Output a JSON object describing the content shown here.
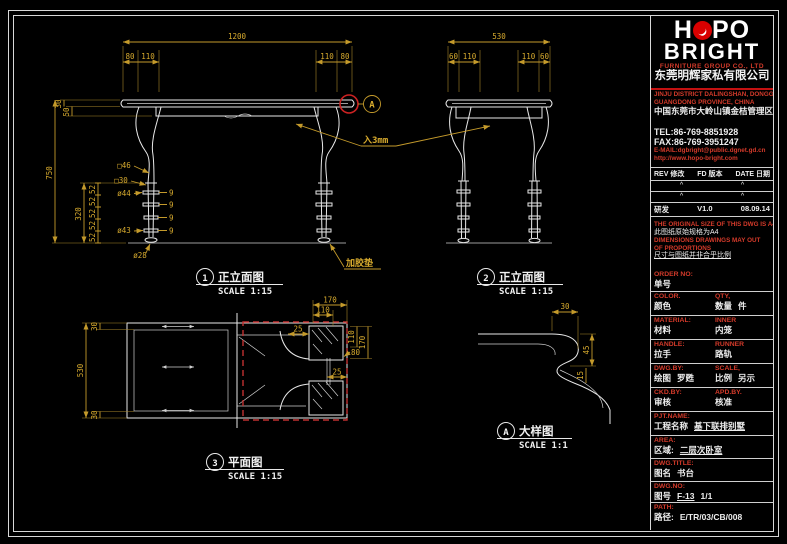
{
  "colors": {
    "background": "#000000",
    "drawing_line": "#e8e8e8",
    "dimension": "#c49a2b",
    "accent_red": "#cc2222",
    "logo_red": "#d90000"
  },
  "logo": {
    "h": "H",
    "po": "PO",
    "bright": "BRIGHT",
    "subtitle": "FURNITURE GROUP CO., LTD",
    "company_cn": "东莞明辉家私有限公司"
  },
  "contact": {
    "addr_en1": "JINJU DISTRICT DALINGSHAN, DONGGUAN",
    "addr_en2": "GUANGDONG PROVINCE, CHINA",
    "addr_cn": "中国东莞市大岭山镇金桔管理区",
    "tel": "TEL:86-769-8851928",
    "fax": "FAX:86-769-3951247",
    "email": "E-MAIL:dgbright@public.dgnet.gd.cn",
    "web": "http://www.hopo-bright.com"
  },
  "revision": {
    "header_rev": "REV 修改",
    "header_fd": "FD 版本",
    "header_date": "DATE 日期",
    "caret": "^",
    "entry": {
      "rev": "研发",
      "fd": "V1.0",
      "date": "08.09.14"
    }
  },
  "notes": {
    "l1": "THE ORIGINAL SIZE OF THIS DWG IS A4",
    "l2": "此图纸原始规格为A4",
    "l3": "DIMENSIONS DRAWINGS MAY OUT",
    "l4": "OF PROPORTIONS",
    "l5": "尺寸与图纸并非合乎比例"
  },
  "order": {
    "label": "ORDER NO:",
    "label_cn": "单号"
  },
  "fields": {
    "color_label": "COLOR.",
    "color_cn": "颜色",
    "qty_label": "QTY,",
    "qty_cn": "数量",
    "qty_unit": "件",
    "material_label": "MATERIAL:",
    "material_cn": "材料",
    "inner_label": "INNER",
    "inner_cn": "内笼",
    "handle_label": "HANDLE:",
    "handle_cn": "拉手",
    "runner_label": "RUNNER",
    "runner_cn": "路轨",
    "dwgby_label": "DWG.BY:",
    "dwgby_cn": "绘图",
    "dwgby_value": "罗甦",
    "scale_label": "SCALE,",
    "scale_cn": "比例",
    "scale_value": "另示",
    "ckdby_label": "CKD.BY:",
    "ckdby_cn": "审核",
    "apdby_label": "APD.BY.",
    "apdby_cn": "核准",
    "pjt_label": "PJT.NAME:",
    "pjt_cn": "工程名称",
    "pjt_value": "基下联排别墅",
    "area_label": "AREA:",
    "area_cn": "区域:",
    "area_value": "二层次卧室",
    "title_label": "DWG.TITLE:",
    "title_cn": "图名",
    "title_value": "书台",
    "no_label": "DWG.NO:",
    "no_cn": "图号",
    "no_value": "F-13",
    "no_page": "1/1",
    "path_label": "PATH:",
    "path_cn": "路径:",
    "path_value": "E/TR/03/CB/008"
  },
  "views": {
    "front": {
      "num": "1",
      "name": "正立面图",
      "scale": "SCALE 1:15",
      "detail_mark": "A",
      "dims": {
        "total": "1200",
        "a80": "80",
        "b110": "110",
        "t30": "30",
        "t50": "50",
        "h750": "750",
        "leg320": "320",
        "seg52": "52",
        "ring9": "9",
        "sq46": "□46",
        "sq30": "□30",
        "d44": "ø44",
        "d43": "ø43",
        "d28": "ø28"
      }
    },
    "side": {
      "num": "2",
      "name": "正立面图",
      "scale": "SCALE 1:15",
      "dims": {
        "total": "530",
        "a60": "60",
        "b110": "110"
      }
    },
    "plan": {
      "num": "3",
      "name": "平面图",
      "scale": "SCALE 1:15",
      "dims": {
        "e30": "30",
        "d530": "530",
        "t170": "170",
        "t110": "110",
        "r110": "110",
        "r170": "170",
        "r80": "80",
        "c25": "25"
      }
    },
    "detail": {
      "num": "A",
      "name": "大样图",
      "scale": "SCALE 1:1",
      "dims": {
        "a30": "30",
        "b45": "45",
        "c15": "15"
      }
    },
    "annotations": {
      "inset": "入3mm",
      "pad": "加胶垫"
    }
  }
}
